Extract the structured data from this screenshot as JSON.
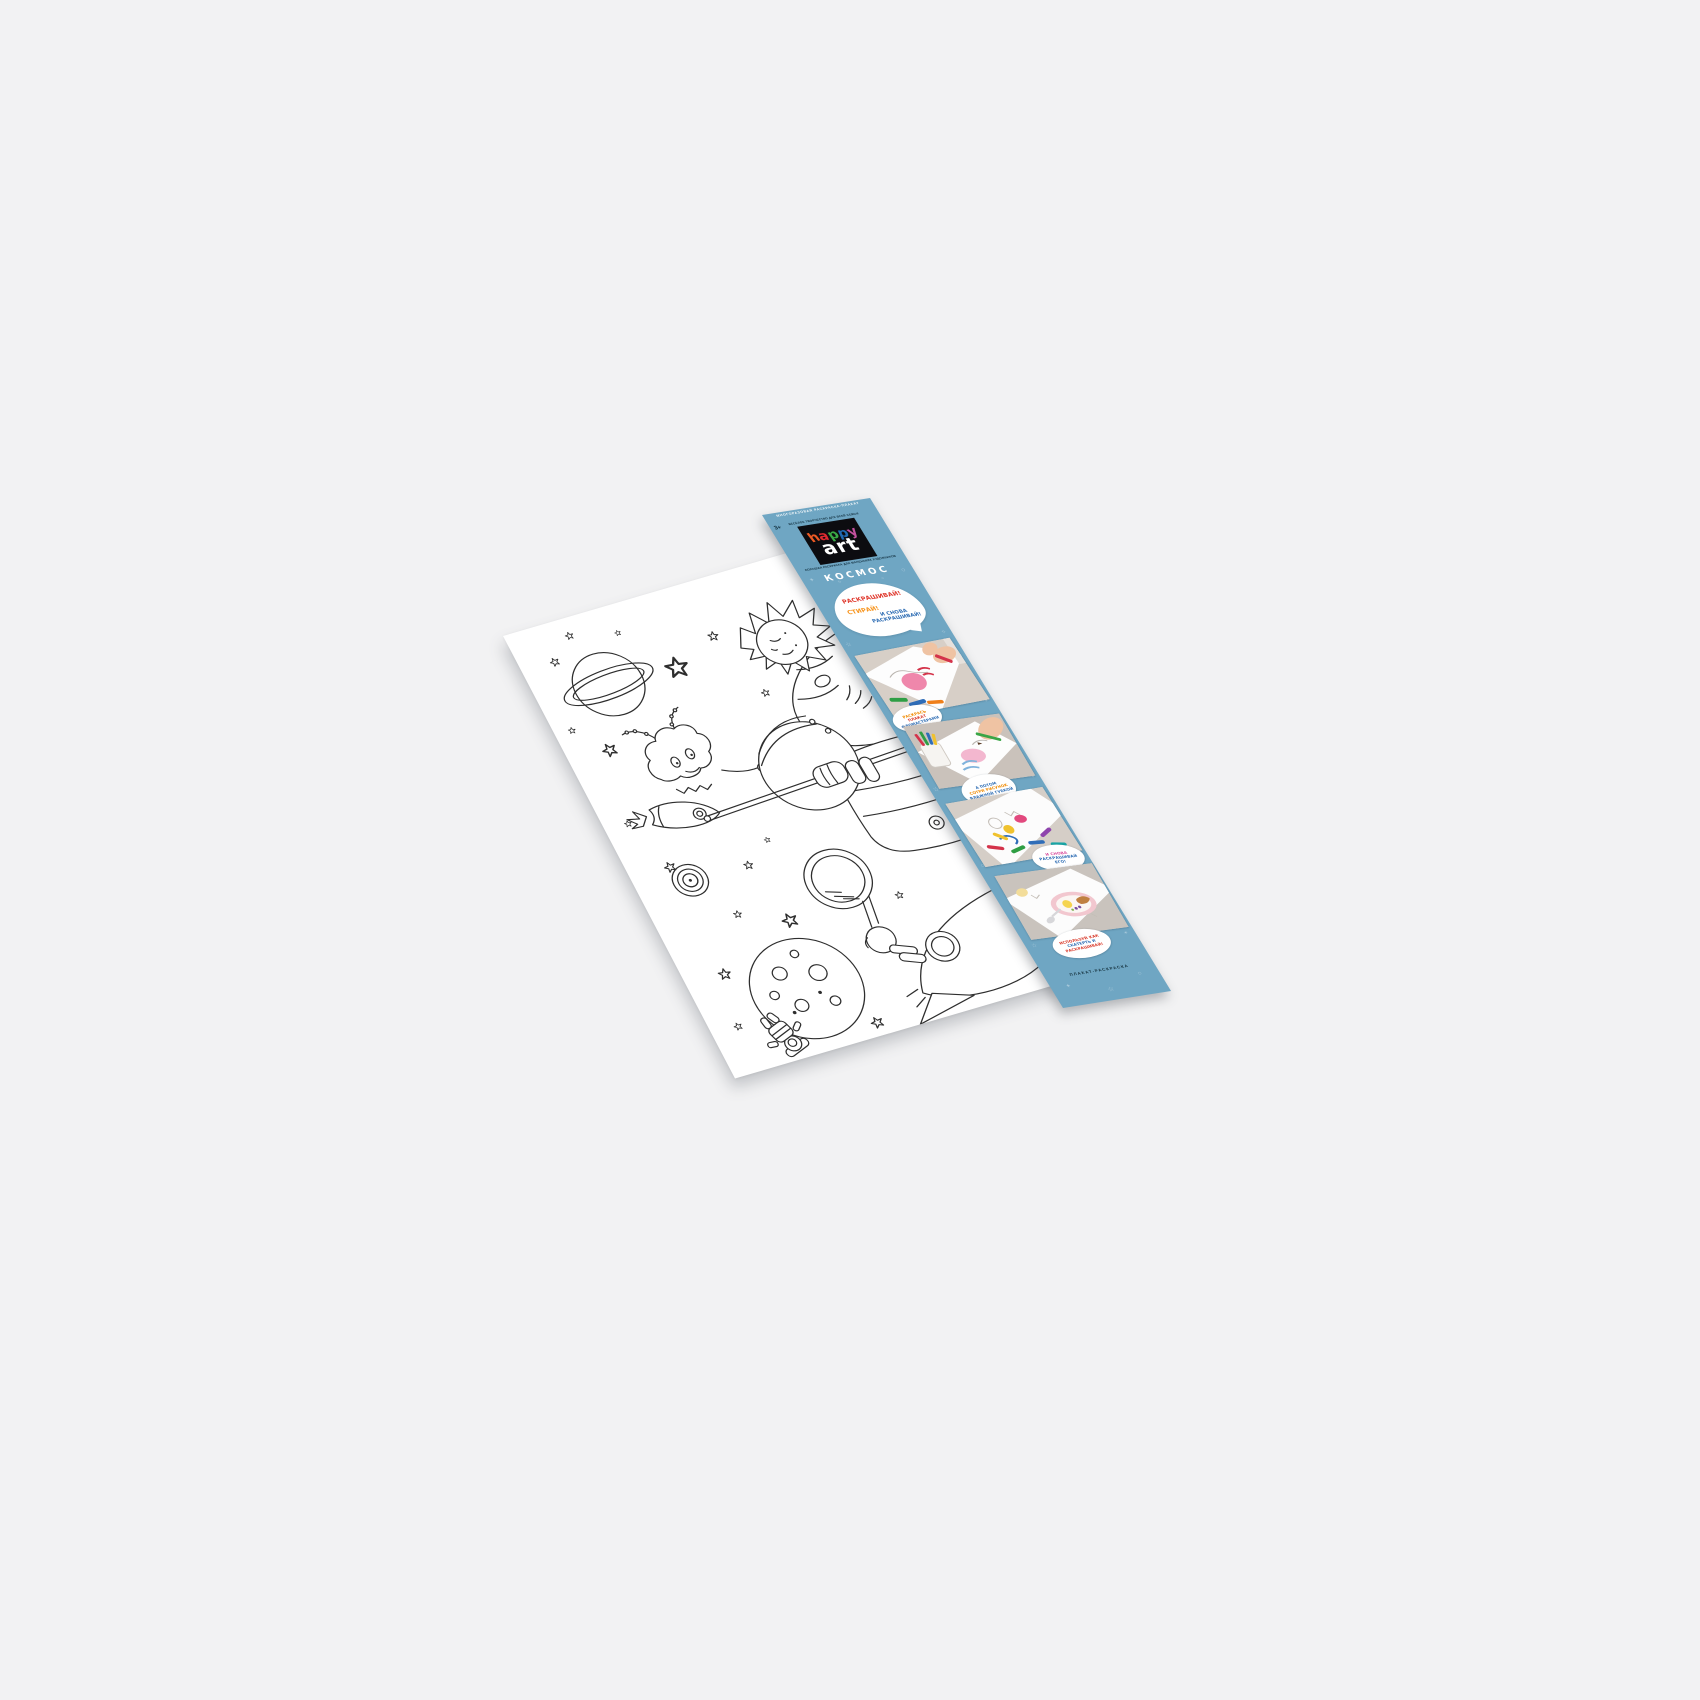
{
  "scene": {
    "background_color": "#F2F2F3"
  },
  "band": {
    "bg_color": "#6FA6C3",
    "edge_note": "МНОГОРАЗОВАЯ РАСКРАСКА-ПЛАКАТ",
    "age_label": "3+",
    "tagline_above_logo": "ВЕСЁЛОЕ ТВОРЧЕСТВО ДЛЯ ВСЕЙ СЕМЬИ",
    "logo": {
      "word1_letters": [
        {
          "char": "h",
          "color": "#EE5A24"
        },
        {
          "char": "a",
          "color": "#E02A2F"
        },
        {
          "char": "p",
          "color": "#3AAA46"
        },
        {
          "char": "p",
          "color": "#2069B2"
        },
        {
          "char": "y",
          "color": "#C4519F"
        }
      ],
      "word2": "art"
    },
    "tagline_below_logo": "БОЛЬШАЯ РАСКРАСКА ДЛЯ МАЛЕНЬКИХ ХУДОЖНИКОВ",
    "title": "КОСМОС",
    "bubble": {
      "line1": {
        "text": "РАСКРАШИВАЙ!",
        "color": "#E0392E"
      },
      "line2": {
        "text": "СТИРАЙ!",
        "color": "#F7941D"
      },
      "line3": {
        "text": "И СНОВА РАСКРАШИВАЙ!",
        "color": "#2E6DB4"
      }
    },
    "steps": [
      {
        "photo_alt": "ребёнок раскрашивает плакат фломастерами",
        "badge_lines": [
          {
            "text": "РАСКРАСЬ",
            "color": "#F08A00"
          },
          {
            "text": "ПЛАКАТ",
            "color": "#D93A2B"
          },
          {
            "text": "ФЛОМАСТЕРАМИ",
            "color": "#2E6DB4"
          }
        ]
      },
      {
        "photo_alt": "раскрашивание деталей рисунка карандашом",
        "badge_lines": [
          {
            "text": "А ПОТОМ",
            "color": "#2E6DB4"
          },
          {
            "text": "СОТРИ РИСУНОК",
            "color": "#F08A00"
          },
          {
            "text": "ВЛАЖНОЙ ГУБКОЙ",
            "color": "#2E6DB4"
          }
        ]
      },
      {
        "photo_alt": "фломастеры лежат на плакате",
        "badge_lines": [
          {
            "text": "И СНОВА",
            "color": "#D84F9E"
          },
          {
            "text": "РАСКРАШИВАЙ",
            "color": "#2E6DB4"
          },
          {
            "text": "ЕГО!",
            "color": "#2E6DB4"
          }
        ]
      },
      {
        "photo_alt": "плакат на столе как скатерть с завтраком",
        "badge_lines": [
          {
            "text": "ИСПОЛЬЗУЙ КАК",
            "color": "#D93A2B"
          },
          {
            "text": "СКАТЕРТЬ И",
            "color": "#2E6DB4"
          },
          {
            "text": "РАСКРАШИВАЙ!",
            "color": "#D93A2B"
          }
        ]
      }
    ],
    "bottom_label": "ПЛАКАТ-РАСКРАСКА",
    "doodles": [
      {
        "c": "✦",
        "x": 14,
        "y": 150,
        "s": 12,
        "r": 0
      },
      {
        "c": "○",
        "x": 196,
        "y": 158,
        "s": 14,
        "r": 0
      },
      {
        "c": "✧",
        "x": 64,
        "y": 166,
        "s": 10,
        "r": 0
      },
      {
        "c": "○",
        "x": 150,
        "y": 172,
        "s": 9,
        "r": 0
      },
      {
        "c": "☆",
        "x": 8,
        "y": 300,
        "s": 13,
        "r": -15
      },
      {
        "c": "✧",
        "x": 200,
        "y": 306,
        "s": 12,
        "r": 10
      },
      {
        "c": "○",
        "x": 10,
        "y": 480,
        "s": 11,
        "r": 0
      },
      {
        "c": "✶",
        "x": 202,
        "y": 470,
        "s": 10,
        "r": 0
      },
      {
        "c": "☆",
        "x": 6,
        "y": 640,
        "s": 14,
        "r": 12
      },
      {
        "c": "✦",
        "x": 202,
        "y": 648,
        "s": 11,
        "r": 0
      },
      {
        "c": "○",
        "x": 8,
        "y": 820,
        "s": 13,
        "r": 0
      },
      {
        "c": "✧",
        "x": 200,
        "y": 826,
        "s": 12,
        "r": -8
      },
      {
        "c": "☆",
        "x": 12,
        "y": 1010,
        "s": 12,
        "r": 8
      },
      {
        "c": "✶",
        "x": 198,
        "y": 1016,
        "s": 10,
        "r": 0
      },
      {
        "c": "✦",
        "x": 30,
        "y": 1108,
        "s": 12,
        "r": 0
      },
      {
        "c": "○",
        "x": 178,
        "y": 1104,
        "s": 13,
        "r": 0
      },
      {
        "c": "☆",
        "x": 104,
        "y": 1128,
        "s": 14,
        "r": -10
      }
    ]
  },
  "poster": {
    "motifs": [
      "saturn",
      "stars",
      "comet",
      "alien",
      "small-rocket",
      "spiral-galaxy",
      "astronaut-with-magnifier",
      "cratered-planet",
      "big-rocket",
      "cratered-moon",
      "floating-astronaut"
    ]
  }
}
